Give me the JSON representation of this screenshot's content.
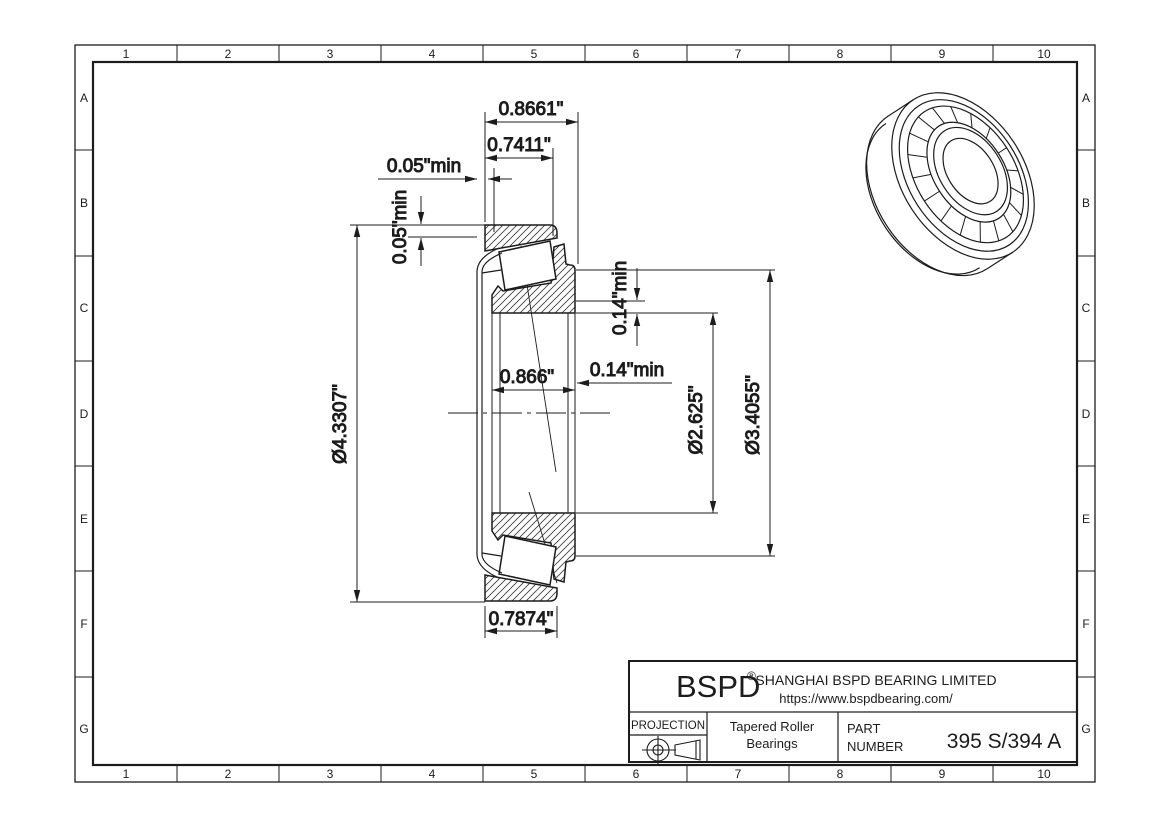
{
  "grid": {
    "columns": [
      "1",
      "2",
      "3",
      "4",
      "5",
      "6",
      "7",
      "8",
      "9",
      "10"
    ],
    "rows": [
      "A",
      "B",
      "C",
      "D",
      "E",
      "F",
      "G"
    ]
  },
  "dimensions": {
    "overall_width": "0.8661\"",
    "cup_front_width": "0.7411\"",
    "front_clearance": "0.05\"min",
    "radial_clearance": "0.05\"min",
    "cone_width": "0.866\"",
    "shoulder_axial": "0.14\"min",
    "shoulder_radial": "0.14\"min",
    "outside_diameter": "Ø4.3307\"",
    "bore_diameter": "Ø2.625\"",
    "flange_diameter": "Ø3.4055\"",
    "cup_width": "0.7874\""
  },
  "title_block": {
    "logo": "BSPD",
    "registered_mark": "®",
    "company_name": "SHANGHAI BSPD BEARING LIMITED",
    "website": "https://www.bspdbearing.com/",
    "projection_label": "PROJECTION",
    "product_line1": "Tapered Roller",
    "product_line2": "Bearings",
    "part_label_line1": "PART",
    "part_label_line2": "NUMBER",
    "part_number": "395 S/394 A"
  },
  "colors": {
    "ink": "#1c1c1c",
    "paper": "#ffffff"
  }
}
